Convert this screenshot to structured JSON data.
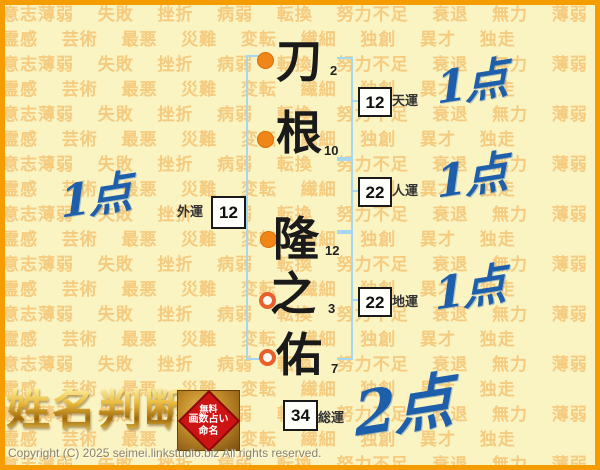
{
  "page": {
    "title": "姓名判断 結果",
    "background_words": "意志薄弱 失敗 挫折 病弱 転換 努力不足 衰退 無力 薄弱 霊感 芸術 最悪 災難 変転 繊細 独創 異才 独走",
    "copyright": "Copyright (C) 2025 seimei.linkstudio.biz All rights reserved."
  },
  "name": {
    "characters": [
      {
        "char": "刀",
        "strokes": "2",
        "part": "surname",
        "marker": "filled"
      },
      {
        "char": "根",
        "strokes": "10",
        "part": "surname",
        "marker": "filled"
      },
      {
        "char": "隆",
        "strokes": "12",
        "part": "given",
        "marker": "filled"
      },
      {
        "char": "之",
        "strokes": "3",
        "part": "given",
        "marker": "hollow"
      },
      {
        "char": "佑",
        "strokes": "7",
        "part": "given",
        "marker": "hollow"
      }
    ]
  },
  "fortunes": {
    "heaven": {
      "value": "12",
      "label": "天運",
      "score": "1点"
    },
    "person": {
      "value": "22",
      "label": "人運",
      "score": "1点"
    },
    "earth": {
      "value": "22",
      "label": "地運",
      "score": "1点"
    },
    "outer": {
      "value": "12",
      "label": "外運",
      "score": "1点"
    },
    "total": {
      "value": "34",
      "label": "総運",
      "score": "2点"
    }
  },
  "footer": {
    "logo": "姓名判断",
    "seal": {
      "line1": "無料",
      "line2": "画数占い",
      "line3": "命名"
    }
  },
  "colors": {
    "frame_orange": "#f59d00",
    "background_yellow": "#faf3c2",
    "watermark_orange": "#f0a43c",
    "bracket_blue": "#a6d7f2",
    "score_blue": "#1e5fac",
    "marker_filled_orange": "#f08518",
    "marker_hollow_ring": "#e9602a",
    "seal_red": "#cd1414",
    "logo_gold": "#c8920a"
  }
}
